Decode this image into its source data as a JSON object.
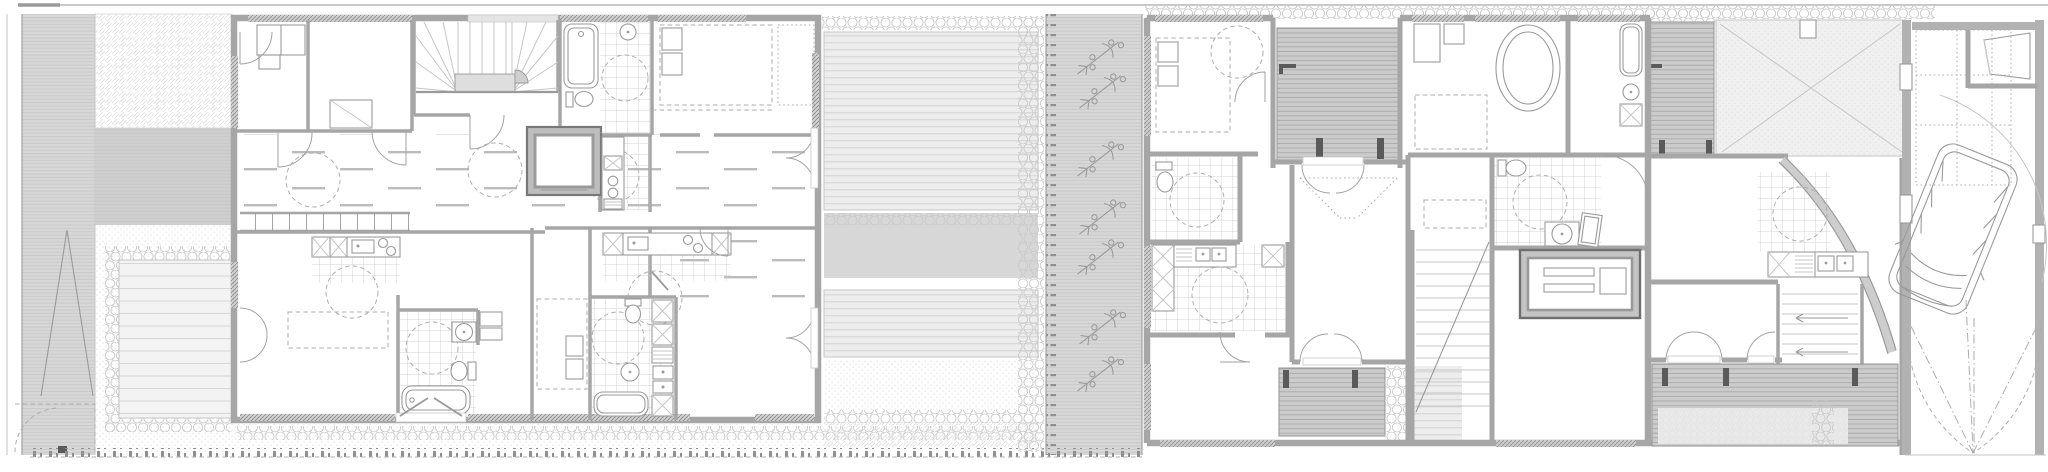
{
  "plan": {
    "kind": "architectural site floor plan, two row buildings with gardens",
    "west_building": [
      "bedrooms",
      "winder-stair",
      "elevator",
      "bathrooms",
      "kitchens",
      "corridor",
      "balcony"
    ],
    "east_building": [
      "bedrooms",
      "straight-stair",
      "storage-box",
      "bathrooms",
      "kitchen",
      "terraces",
      "basement-stair"
    ],
    "site": [
      "road-strip",
      "tree",
      "hedges",
      "deck-terraces",
      "bike-strip",
      "carport",
      "van",
      "gates",
      "fence"
    ],
    "bicycle_count": 7,
    "van_count": 1,
    "tree_count": 1
  },
  "colors": {
    "paper": "#ffffff",
    "wall": "#a6a6a6",
    "line": "#9a9a9a",
    "lightline": "#c6c6c6",
    "dash": "#aeaeae",
    "doorline": "#a2a2a2",
    "post": "#5a5a5a",
    "deckdark": "#cbcbcb",
    "deckdarkline": "#a9a9a9",
    "deckmid": "#ededed",
    "deckmidline": "#d2d2d2",
    "deckwide": "#f3f3f3",
    "deckwideline": "#d6d6d6",
    "band": "#d7d7d7",
    "bandline": "#c6c6c6",
    "graysolid": "#cfcfcf",
    "hedge": "#c9c9c9",
    "tile": "#c5c5c5",
    "stipple": "#dcdcdc",
    "diagonal": "#e2e2e2",
    "winbg": "#d0d0d0",
    "winline": "#8e8e8e",
    "plank": "#bcbcbc",
    "fence": "#8f8f8f",
    "landing": "#dedede",
    "property": "#c9c9c9"
  }
}
